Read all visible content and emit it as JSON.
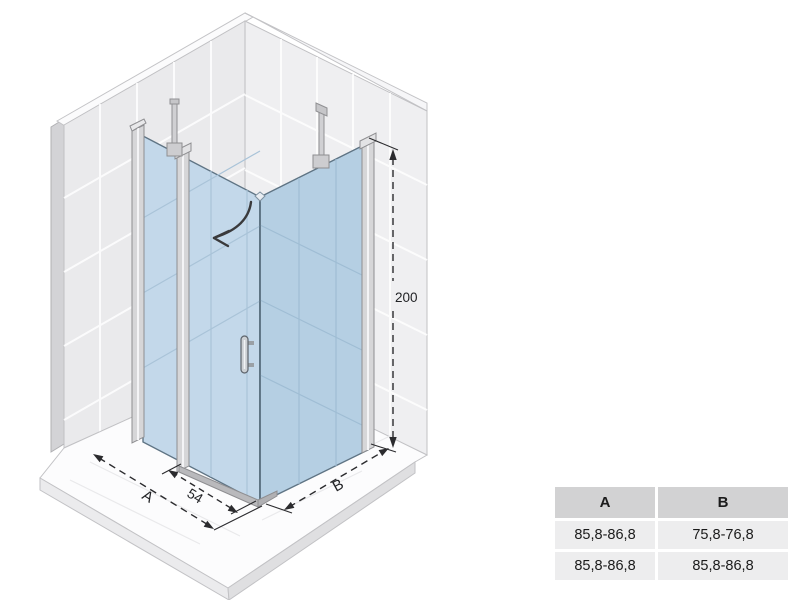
{
  "diagram": {
    "dimension_labels": {
      "a": "A",
      "b": "B",
      "door_width": "54",
      "height": "200"
    },
    "icons": {
      "door_swing": "curved-arrow"
    },
    "colors": {
      "glass_left": "#c3d8ea",
      "glass_right": "#b5cfe3",
      "glass_edge": "#5f7484",
      "wall_tile_left": "#eaeaec",
      "wall_tile_right": "#efeff1",
      "wall_edge_strip": "#d3d3d6",
      "chrome_profile": "#d6d6d8",
      "dimension_ink": "#2b2b2e",
      "floor": "#fcfcfd"
    }
  },
  "size_table": {
    "headers": [
      "A",
      "B"
    ],
    "rows": [
      [
        "85,8-86,8",
        "75,8-76,8"
      ],
      [
        "85,8-86,8",
        "85,8-86,8"
      ]
    ]
  }
}
